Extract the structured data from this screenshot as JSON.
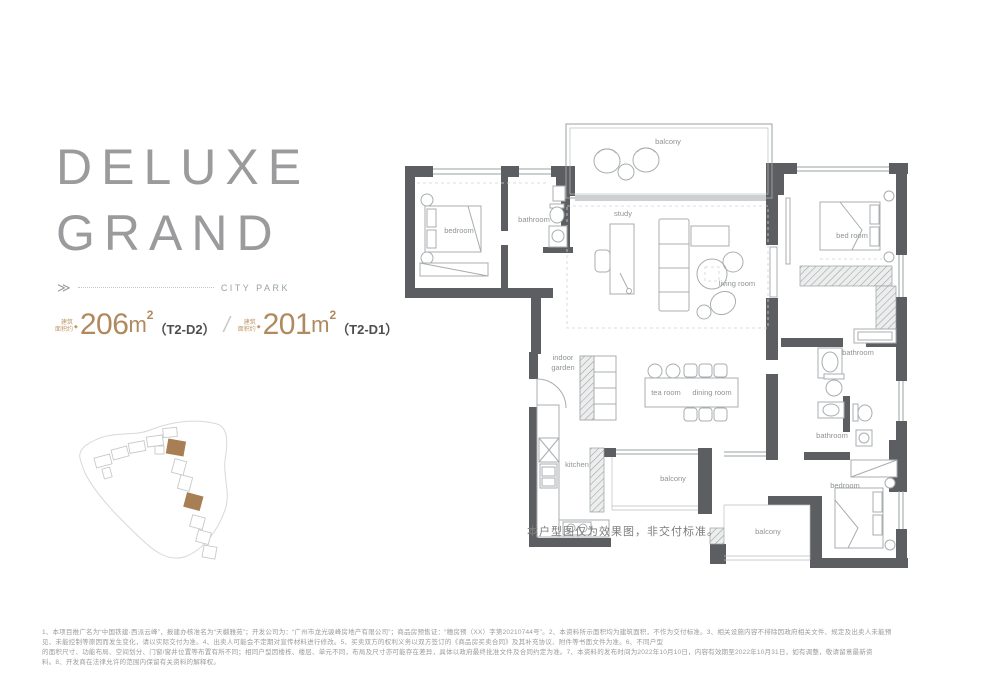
{
  "hero": {
    "title_line1": "DELUXE",
    "title_line2": "GRAND",
    "arrow_glyph": "≫",
    "divider_label": "CITY PARK"
  },
  "specs": {
    "prefix_label": "建筑\n面积约",
    "bullet": "◆",
    "separator": "/",
    "accent_color": "#b1895e",
    "items": [
      {
        "area": "206",
        "unit": "m",
        "sup": "2",
        "type": "（T2-D2）"
      },
      {
        "area": "201",
        "unit": "m",
        "sup": "2",
        "type": "（T2-D1）"
      }
    ]
  },
  "siteplan": {
    "highlight_color": "#a87f55"
  },
  "floorplan": {
    "caption": "本户型图仅为效果图，非交付标准。",
    "rooms": [
      {
        "label": "balcony"
      },
      {
        "label": "bedroom"
      },
      {
        "label": "bathroom"
      },
      {
        "label": "study"
      },
      {
        "label": "living room"
      },
      {
        "label": "bed room"
      },
      {
        "label": "bathroom"
      },
      {
        "label": "bathroom"
      },
      {
        "label_line1": "indoor",
        "label_line2": "garden"
      },
      {
        "label": "tea room"
      },
      {
        "label": "dining room"
      },
      {
        "label": "kitchen"
      },
      {
        "label": "balcony"
      },
      {
        "label": "bedroom"
      },
      {
        "label": "balcony"
      }
    ]
  },
  "footer": {
    "lines": [
      "1、本项目推广名为“中国铁建·西派云峰”，报建办核准名为“天樾雅苑”；开发公司为：“广州市龙光骏峰房地产有限公司”；商品房预售证：“穗房预（XX）字第20210744号”。2、本资料所示面积均为建筑面积，不作为交付标准。3、相关设施内容不排除因政府相关文件、规定及出卖人未能预",
      "见、未能控制等原因而发生变化，请以实际交付为准。4、出卖人可能会不定期对宣传材料进行修改。5、买卖双方的权利义务以双方签订的《商品房买卖合同》及其补充协议、附件等书面文件为准。6、不同户型",
      "的面积尺寸、功能布局、空间划分、门窗/窗井位置等布置有所不同；相同户型因楼栋、楼层、单元不同，布局及尺寸亦可能存在差异，具体以政府最终批准文件及合同约定为准。7、本资料的发布时间为2022年10月10日，内容有效期至2022年10月31日，如有调整，敬请留意最新资",
      "料。8、开发商在法律允许的范围内保留有关资料的解释权。"
    ]
  }
}
